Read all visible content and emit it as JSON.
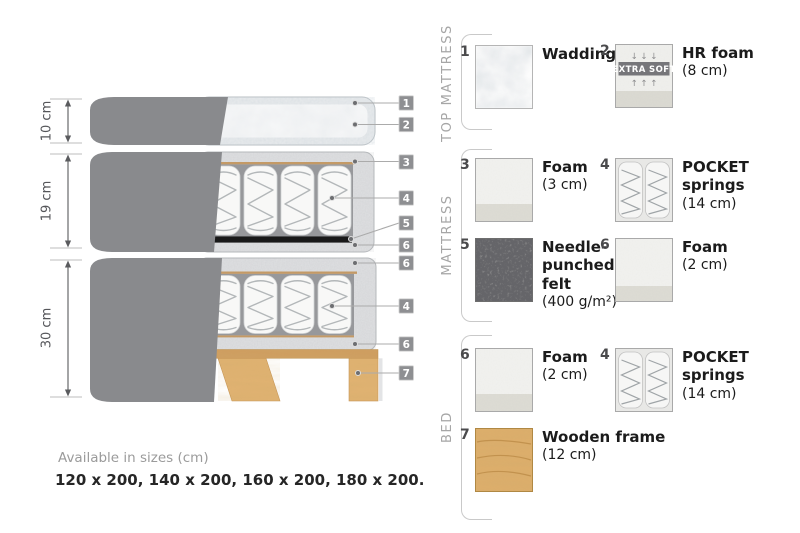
{
  "diagram": {
    "dims": [
      "10 cm",
      "19 cm",
      "30 cm"
    ],
    "callouts": [
      "1",
      "2",
      "3",
      "4",
      "5",
      "6",
      "6",
      "4",
      "6",
      "7"
    ]
  },
  "legend": {
    "sections": [
      {
        "title": "TOP MATTRESS",
        "items": [
          {
            "number": "1",
            "name": "Wadding",
            "size": ""
          },
          {
            "number": "2",
            "name": "HR foam",
            "size": "(8 cm)",
            "badge": "EXTRA SOFT",
            "arrows_down": "↓ ↓ ↓",
            "arrows_up": "↑ ↑ ↑"
          }
        ]
      },
      {
        "title": "MATTRESS",
        "items": [
          {
            "number": "3",
            "name": "Foam",
            "size": "(3 cm)"
          },
          {
            "number": "4",
            "name": "POCKET\nsprings",
            "size": "(14 cm)"
          },
          {
            "number": "5",
            "name": "Needle-\npunched\nfelt",
            "size": "(400 g/m²)"
          },
          {
            "number": "6",
            "name": "Foam",
            "size": "(2 cm)"
          }
        ]
      },
      {
        "title": "BED",
        "items": [
          {
            "number": "6",
            "name": "Foam",
            "size": "(2 cm)"
          },
          {
            "number": "4",
            "name": "POCKET\nsprings",
            "size": "(14 cm)"
          },
          {
            "number": "7",
            "name": "Wooden frame",
            "size": "(12 cm)"
          }
        ]
      }
    ]
  },
  "footer": {
    "label": "Available in sizes (cm)",
    "values": "120 x 200, 140 x 200, 160 x 200, 180 x 200."
  },
  "colors": {
    "cover_gray": "#898a8d",
    "foam_speckle": "#dfe0e2",
    "springs_bg": "#97989b",
    "felt_black": "#191919",
    "wood": "#e0b271",
    "tan_line": "#c49a66",
    "callout_bg": "#8e8f92"
  }
}
